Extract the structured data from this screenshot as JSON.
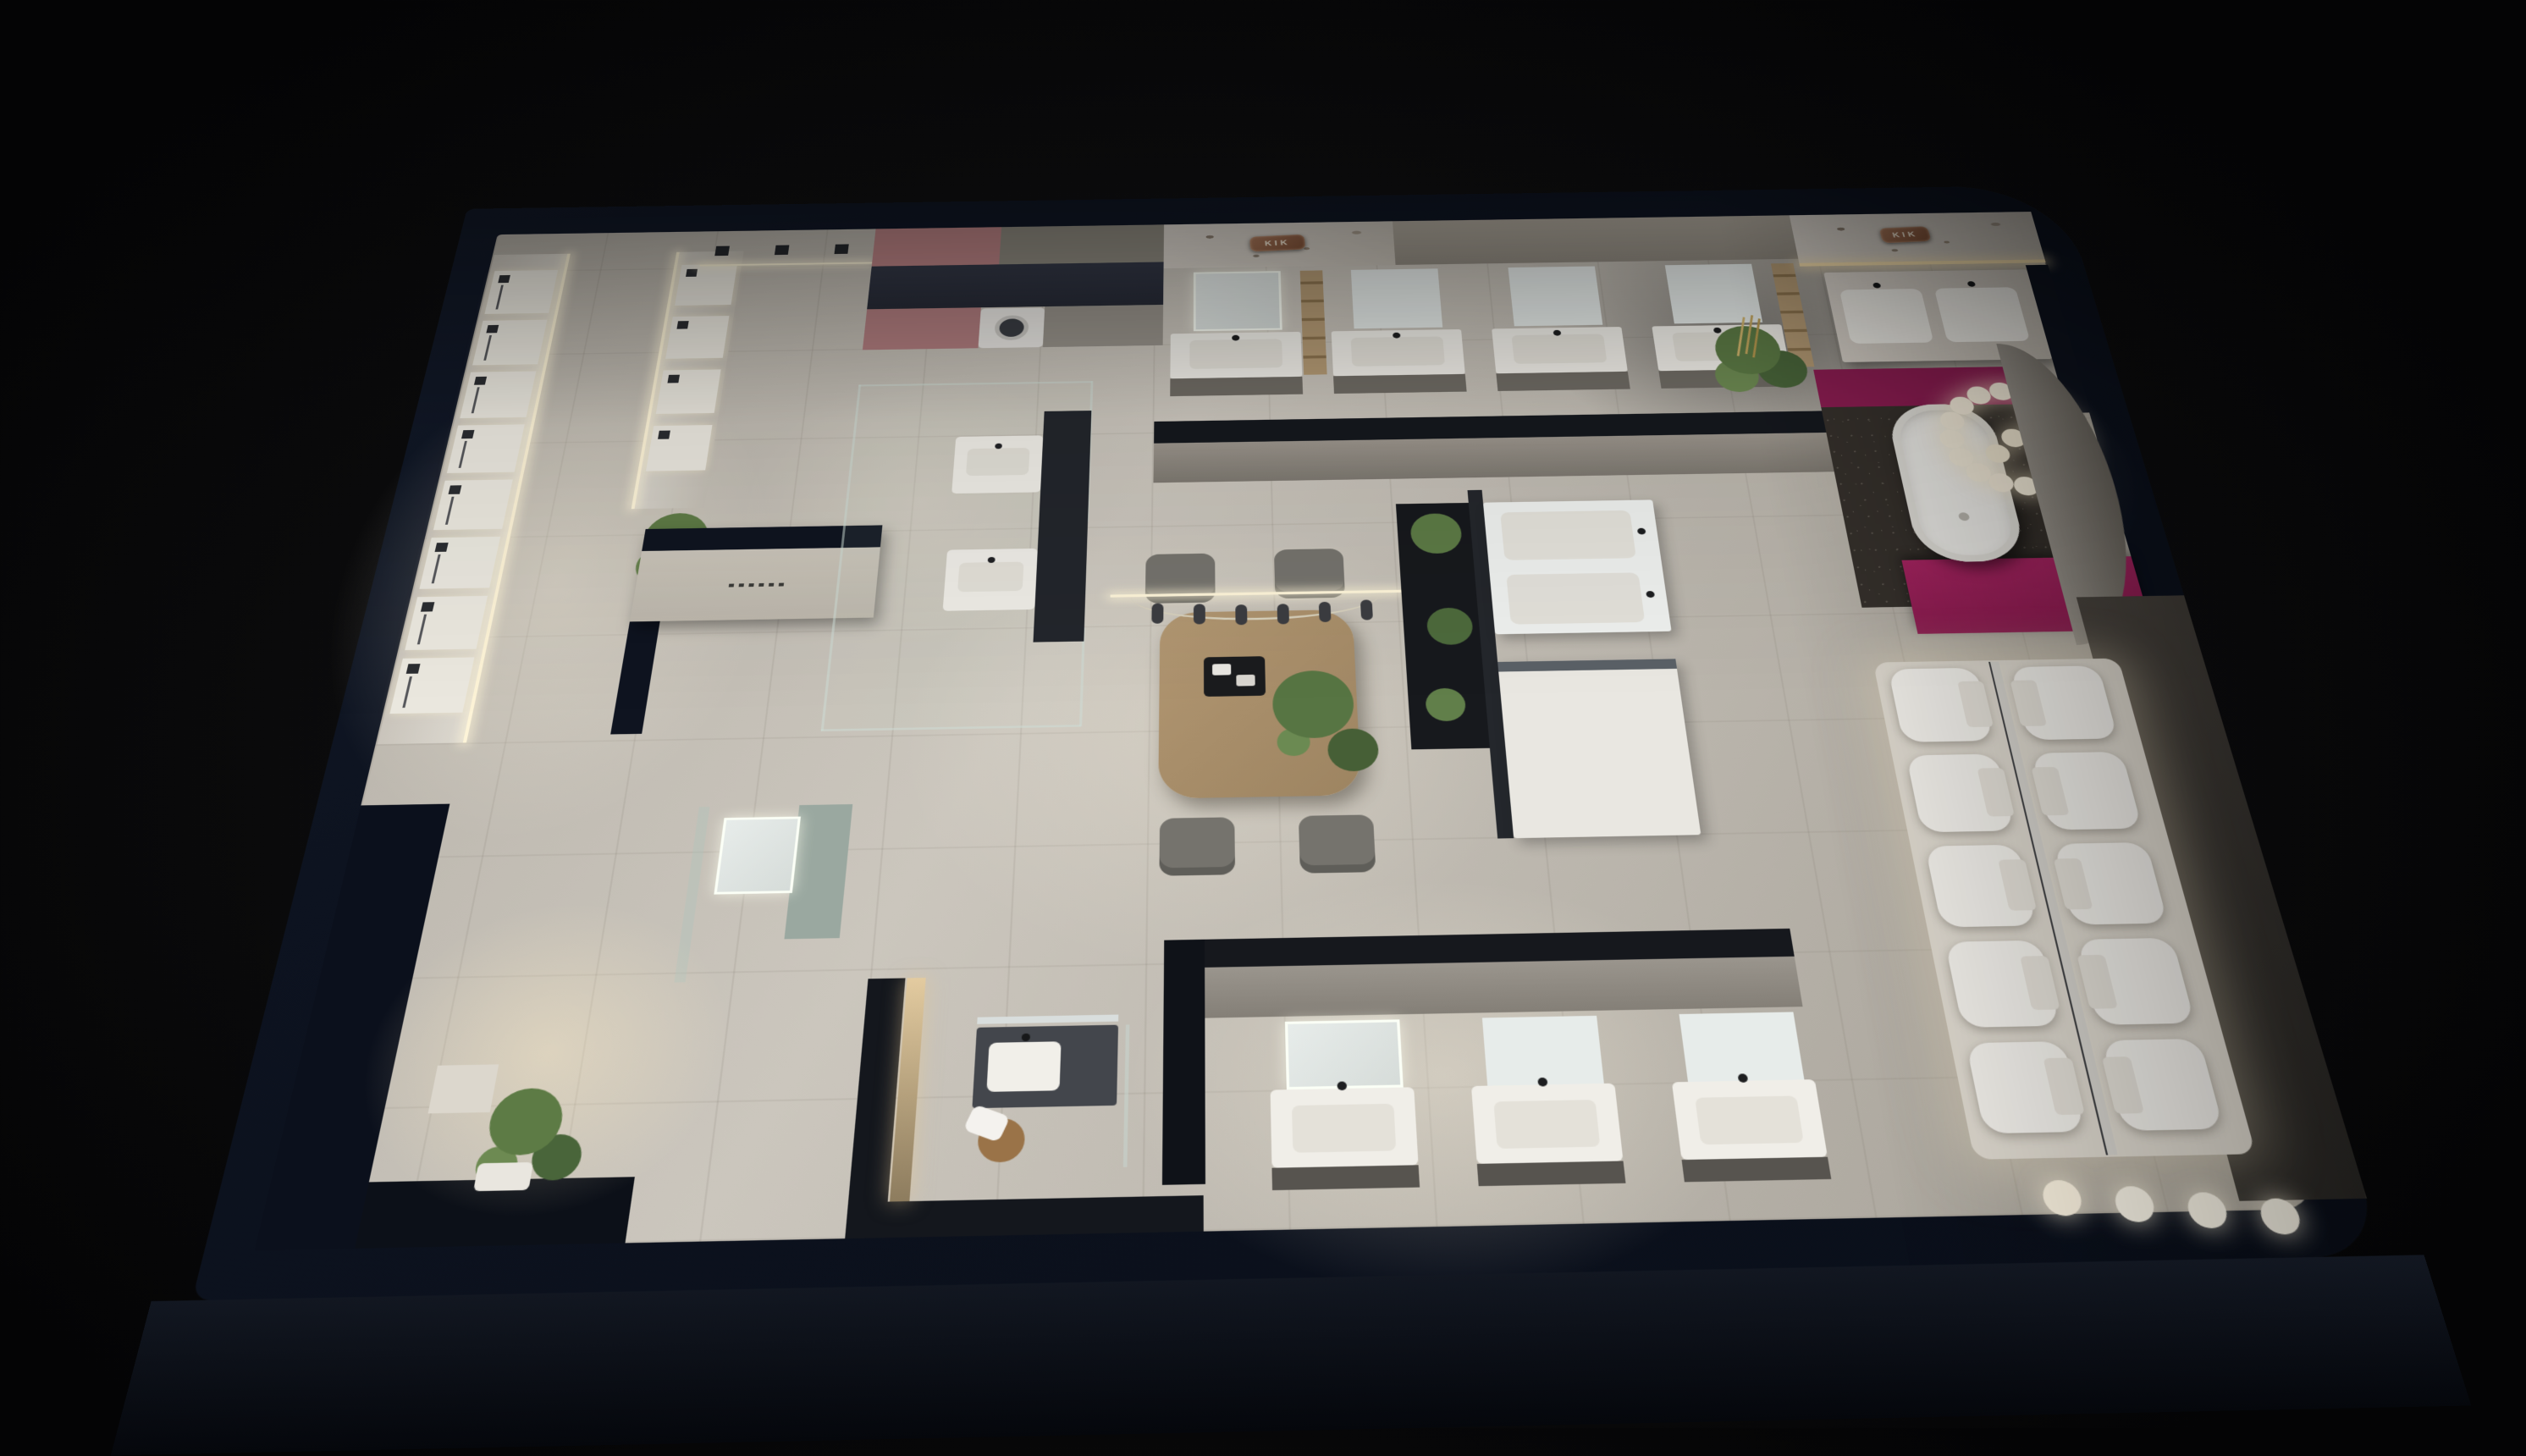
{
  "meta": {
    "scene": "Bird's-eye night render of a bathroom sanitaryware showroom"
  },
  "signage": {
    "left_plaque_text": "KIK",
    "right_plaque_text": "KIK"
  },
  "palette": {
    "background": "#0a0a0b",
    "outer_wall_navy": "#0e1420",
    "floor_light": "#cbc6bd",
    "marble": "#d6d0c7",
    "magenta_accent": "#97205a",
    "copper_plaque": "#8a5c41",
    "led_warm": "#f6ecd2",
    "wood": "#a98f6c",
    "plant_green": "#55713f",
    "glass_tint": "#9fb0ab",
    "sparkle_floor": "#36312c"
  },
  "fixtures": {
    "shower_display_panels": 12,
    "ceiling_shower_heads": 3,
    "top_wall_vanity_units": 4,
    "island_vanity_units": 2,
    "glass_room_vanity_units": 2,
    "partition_vanity_units": 3,
    "double_sink_vanities": 1,
    "bathtubs": 1,
    "toilets_on_platform": 10,
    "washing_machines": 1,
    "lounge_chairs": 4,
    "chandelier_bulbs": 19,
    "entrance_pendant_lights": 4,
    "potted_plants": 6
  }
}
